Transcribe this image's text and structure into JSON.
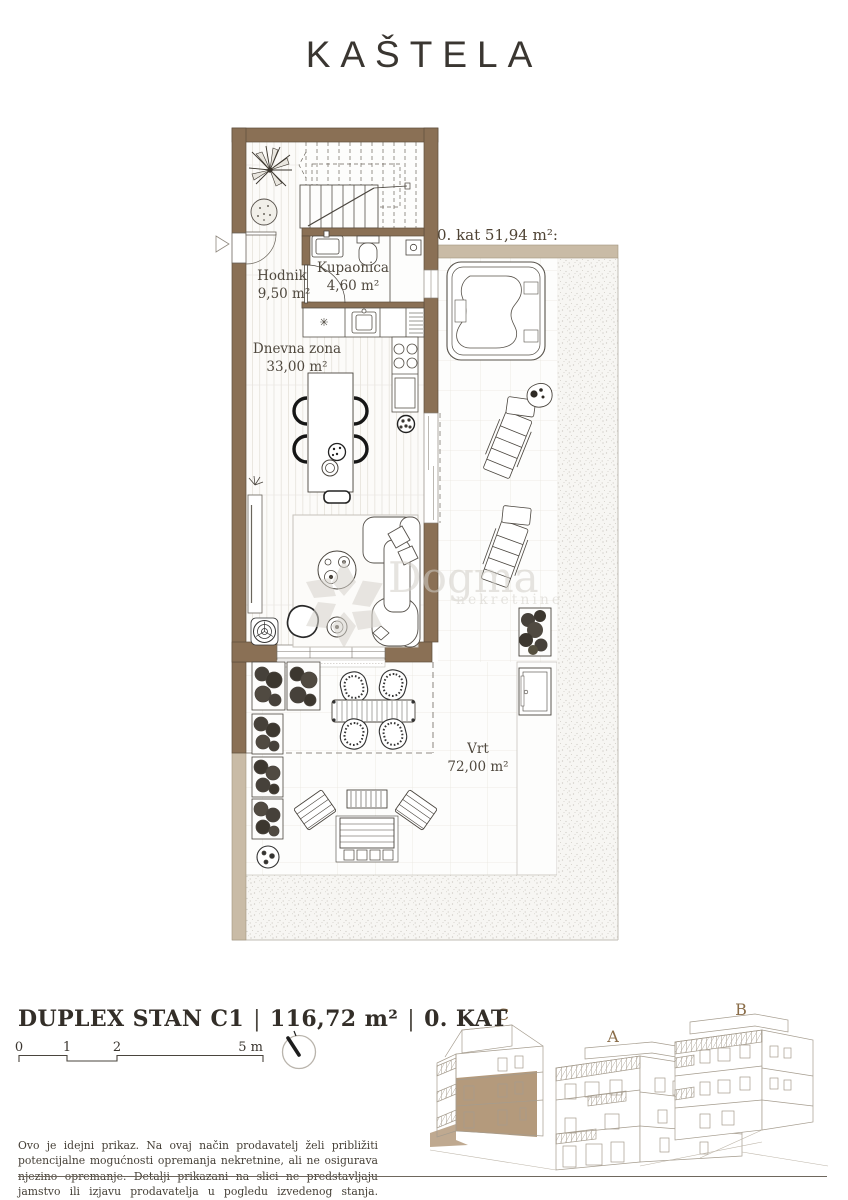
{
  "header": {
    "title": "KAŠTELA"
  },
  "plan": {
    "floor_label": "0. kat 51,94 m²:",
    "rooms": [
      {
        "name": "Hodnik",
        "area": "9,50 m²"
      },
      {
        "name": "Kupaonica",
        "area": "4,60 m²"
      },
      {
        "name": "Dnevna zona",
        "area": "33,00 m²"
      },
      {
        "name": "Vrt",
        "area": "72,00 m²"
      }
    ],
    "watermark": {
      "brand": "Dogma",
      "subtitle": "nekretnine"
    }
  },
  "footer": {
    "unit": {
      "name": "DUPLEX STAN C1",
      "separator": "|",
      "area": "116,72 m²",
      "floor": "0. KAT"
    },
    "scale_bar": {
      "labels": [
        "0",
        "1",
        "2",
        "5 m"
      ]
    },
    "buildings": {
      "labels": [
        "C",
        "A",
        "B"
      ]
    },
    "disclaimer": "Ovo je idejni prikaz. Na ovaj način prodavatelj želi približiti potencijalne mogućnosti opremanja nekretnine, ali ne osigurava njezino opremanje. Detalji prikazani na slici ne predstavljaju jamstvo ili izjavu prodavatelja u pogledu izvedenog stanja. Izvedeno stanje može varirati."
  },
  "colors": {
    "wall_brown": "#8a7055",
    "low_wall_tan": "#c9bba6",
    "unit_highlight": "#b49a7c",
    "label_text": "#4f483e"
  }
}
